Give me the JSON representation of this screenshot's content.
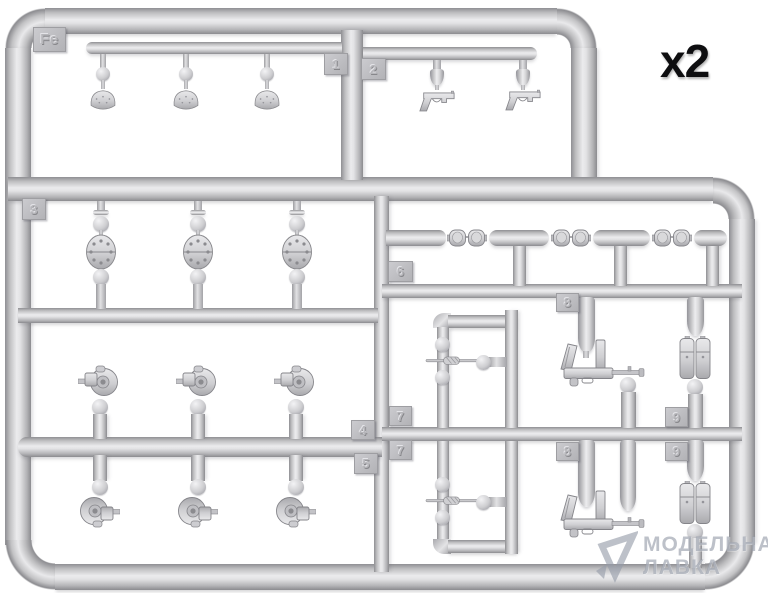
{
  "quantity_label": "x2",
  "sprue": {
    "letter_plate": "Fe",
    "tags": {
      "t1": "1",
      "t2": "2",
      "t3": "3",
      "t4": "4",
      "t5": "5",
      "t6": "6",
      "t7": "7",
      "t8": "8",
      "t9": "9"
    },
    "part_types": [
      "helmet",
      "pistol",
      "perforated-disc",
      "goggles",
      "gun-breech-curl",
      "cleaning-rod",
      "submachine-gun",
      "ammo-pouch"
    ],
    "plastic_color": "#cfcfd2"
  },
  "watermark": {
    "line1": "МОДЕЛЬНАЯ",
    "line2": "ЛАВКА"
  },
  "colors": {
    "background": "#ffffff",
    "label_text": "#0e0e10",
    "watermark_text": "#949BA8"
  }
}
